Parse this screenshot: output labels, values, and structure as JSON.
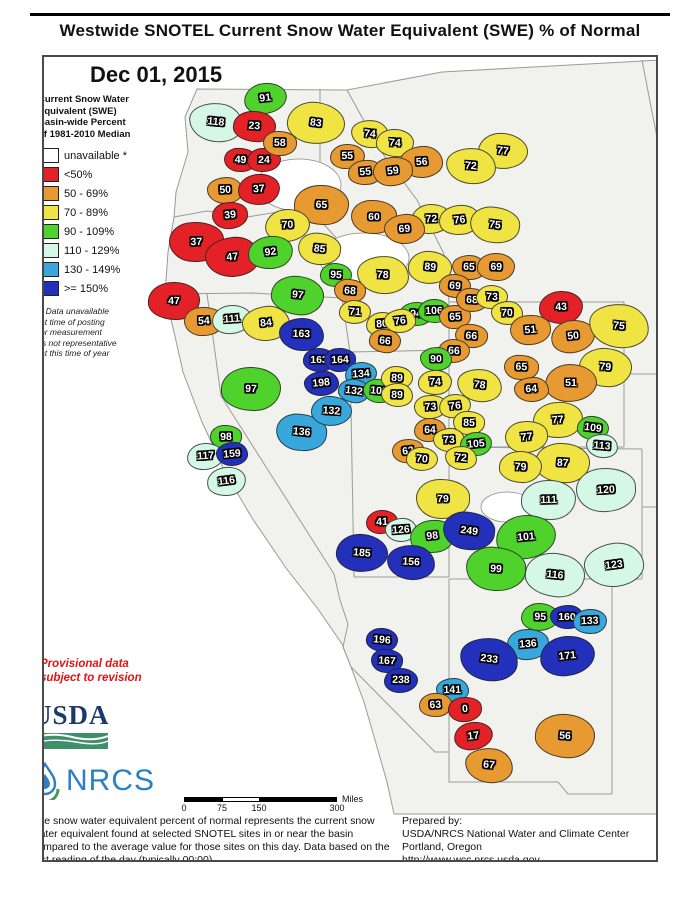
{
  "title": "Westwide SNOTEL Current Snow Water Equivalent (SWE) % of Normal",
  "date": "Dec 01, 2015",
  "legend": {
    "heading": "Current Snow Water\nEquivalent (SWE)\nBasin-wide Percent\nof 1981-2010 Median",
    "classes": [
      {
        "label": "unavailable *",
        "color": "#FFFFFF"
      },
      {
        "label": "<50%",
        "color": "#E42127"
      },
      {
        "label": "50 - 69%",
        "color": "#E79A31"
      },
      {
        "label": "70 - 89%",
        "color": "#F0E344"
      },
      {
        "label": "90 - 109%",
        "color": "#4FD32C"
      },
      {
        "label": "110 - 129%",
        "color": "#D4F7E6"
      },
      {
        "label": "130 - 149%",
        "color": "#38A8DC"
      },
      {
        "label": ">= 150%",
        "color": "#2330BC"
      }
    ],
    "footnote": "*  Data unavailable\nat time of posting\nor measurement\nis not representative\nat this time of year"
  },
  "provisional_note": "Provisional data\nsubject to revision",
  "logos": {
    "usda": "USDA",
    "nrcs": "NRCS"
  },
  "scale_bar": {
    "ticks": [
      "0",
      "75",
      "150",
      "300"
    ],
    "unit": "Miles"
  },
  "description": "The snow water equivalent percent of normal represents the current snow water equivalent found at selected SNOTEL sites in or near the basin compared to the average value for those sites on this day. Data based on the first reading of the day (typically 00:00).",
  "prepared_by": {
    "label": "Prepared by:",
    "org": "USDA/NRCS National Water and Climate Center",
    "city": "Portland, Oregon",
    "url": "http://www.wcc.nrcs.usda.gov"
  },
  "basins": [
    [
      91,
      262,
      96
    ],
    [
      118,
      213,
      120
    ],
    [
      23,
      251,
      124
    ],
    [
      49,
      238,
      157
    ],
    [
      24,
      261,
      157
    ],
    [
      50,
      222,
      187
    ],
    [
      37,
      256,
      186
    ],
    [
      39,
      227,
      212
    ],
    [
      83,
      313,
      120
    ],
    [
      74,
      367,
      131
    ],
    [
      74,
      392,
      140
    ],
    [
      58,
      277,
      140
    ],
    [
      55,
      344,
      154
    ],
    [
      56,
      419,
      159
    ],
    [
      55,
      362,
      170
    ],
    [
      59,
      390,
      169
    ],
    [
      77,
      500,
      148
    ],
    [
      72,
      468,
      163
    ],
    [
      65,
      318,
      202
    ],
    [
      60,
      371,
      214
    ],
    [
      72,
      428,
      216
    ],
    [
      69,
      401,
      226
    ],
    [
      76,
      457,
      217
    ],
    [
      75,
      492,
      222
    ],
    [
      89,
      427,
      264
    ],
    [
      65,
      466,
      264
    ],
    [
      69,
      493,
      264
    ],
    [
      37,
      193,
      239
    ],
    [
      70,
      285,
      223
    ],
    [
      47,
      229,
      254
    ],
    [
      92,
      268,
      250
    ],
    [
      85,
      317,
      246
    ],
    [
      95,
      333,
      272
    ],
    [
      78,
      380,
      272
    ],
    [
      47,
      171,
      298
    ],
    [
      54,
      201,
      319
    ],
    [
      111,
      229,
      317
    ],
    [
      84,
      263,
      321
    ],
    [
      97,
      295,
      293
    ],
    [
      68,
      347,
      288
    ],
    [
      71,
      352,
      309
    ],
    [
      94,
      413,
      311
    ],
    [
      106,
      431,
      308
    ],
    [
      65,
      452,
      314
    ],
    [
      80,
      379,
      321
    ],
    [
      76,
      397,
      318
    ],
    [
      66,
      382,
      338
    ],
    [
      66,
      468,
      333
    ],
    [
      66,
      451,
      348
    ],
    [
      90,
      433,
      356
    ],
    [
      74,
      432,
      380
    ],
    [
      73,
      428,
      404
    ],
    [
      76,
      452,
      403
    ],
    [
      78,
      477,
      383
    ],
    [
      69,
      452,
      283
    ],
    [
      68,
      469,
      297
    ],
    [
      73,
      489,
      294
    ],
    [
      70,
      504,
      310
    ],
    [
      43,
      558,
      304
    ],
    [
      51,
      527,
      327
    ],
    [
      50,
      570,
      333
    ],
    [
      75,
      616,
      323
    ],
    [
      79,
      602,
      364
    ],
    [
      65,
      518,
      365
    ],
    [
      51,
      568,
      380
    ],
    [
      64,
      528,
      387
    ],
    [
      77,
      555,
      417
    ],
    [
      77,
      524,
      434
    ],
    [
      109,
      590,
      425
    ],
    [
      113,
      599,
      443
    ],
    [
      87,
      560,
      460
    ],
    [
      85,
      466,
      420
    ],
    [
      64,
      427,
      427
    ],
    [
      73,
      446,
      437
    ],
    [
      105,
      473,
      441
    ],
    [
      62,
      405,
      448
    ],
    [
      70,
      419,
      456
    ],
    [
      72,
      458,
      455
    ],
    [
      79,
      518,
      464
    ],
    [
      79,
      440,
      496
    ],
    [
      41,
      379,
      519
    ],
    [
      126,
      398,
      527
    ],
    [
      98,
      429,
      533
    ],
    [
      249,
      466,
      528
    ],
    [
      185,
      359,
      550
    ],
    [
      156,
      408,
      560
    ],
    [
      97,
      248,
      386
    ],
    [
      98,
      223,
      434
    ],
    [
      117,
      203,
      454
    ],
    [
      159,
      229,
      451
    ],
    [
      116,
      224,
      478
    ],
    [
      136,
      299,
      430
    ],
    [
      132,
      328,
      408
    ],
    [
      163,
      298,
      331
    ],
    [
      163,
      316,
      357
    ],
    [
      164,
      337,
      357
    ],
    [
      134,
      358,
      371
    ],
    [
      198,
      318,
      381
    ],
    [
      132,
      351,
      388
    ],
    [
      103,
      376,
      388
    ],
    [
      89,
      394,
      375
    ],
    [
      89,
      394,
      392
    ],
    [
      111,
      546,
      497
    ],
    [
      120,
      603,
      487
    ],
    [
      101,
      523,
      534
    ],
    [
      123,
      611,
      562
    ],
    [
      116,
      552,
      572
    ],
    [
      99,
      493,
      566
    ],
    [
      95,
      537,
      614
    ],
    [
      160,
      564,
      614
    ],
    [
      133,
      587,
      618
    ],
    [
      136,
      525,
      641
    ],
    [
      171,
      564,
      653
    ],
    [
      233,
      486,
      656
    ],
    [
      196,
      379,
      637
    ],
    [
      167,
      384,
      658
    ],
    [
      238,
      398,
      677
    ],
    [
      141,
      449,
      687
    ],
    [
      63,
      432,
      702
    ],
    [
      0,
      462,
      707
    ],
    [
      17,
      470,
      733
    ],
    [
      67,
      486,
      763
    ],
    [
      56,
      562,
      733
    ]
  ]
}
